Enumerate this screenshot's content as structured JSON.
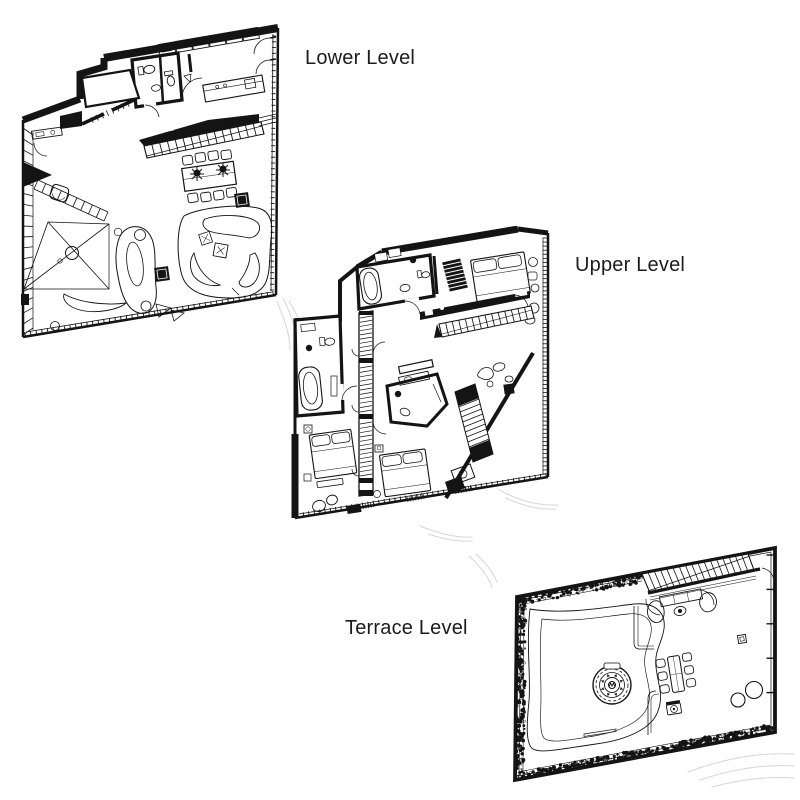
{
  "page": {
    "background": "#ffffff"
  },
  "plans": [
    {
      "id": "lower-level",
      "label": "Lower Level"
    },
    {
      "id": "upper-level",
      "label": "Upper Level"
    },
    {
      "id": "terrace-level",
      "label": "Terrace Level"
    }
  ],
  "colors": {
    "ink": "#141414",
    "paper": "#ffffff",
    "sketch": "#cccccc"
  }
}
